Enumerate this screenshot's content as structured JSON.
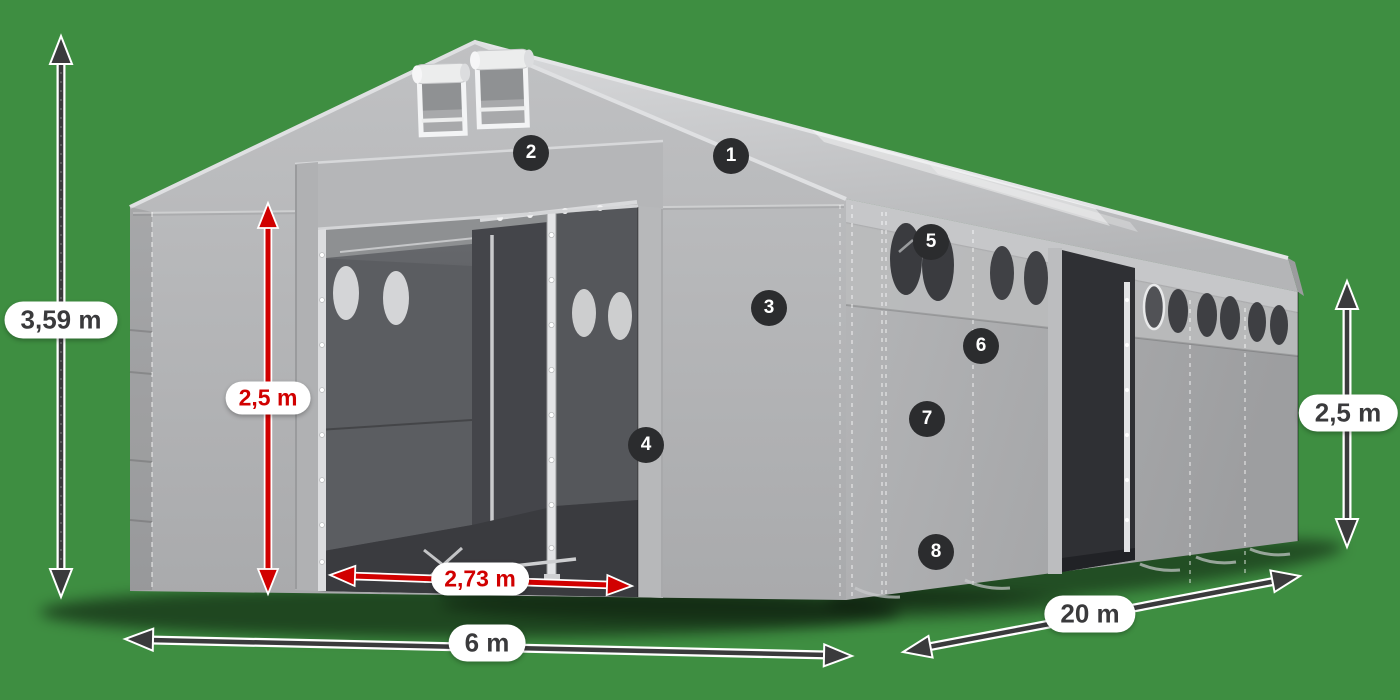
{
  "colors": {
    "background": "#3e8e41",
    "accent_red": "#d10000",
    "arrow_dark": "#3a3a3c",
    "badge_background": "#2b2c2e",
    "badge_text": "#ffffff",
    "label_background": "#ffffff",
    "label_text_dark": "#3a3a3c",
    "tent_fabric_light": "#c9cacc",
    "tent_fabric_mid": "#b3b4b6",
    "tent_interior_dark": "#4a4c50"
  },
  "diagram": {
    "dimension_labels": [
      {
        "id": "total-height",
        "label": "3,59 m",
        "style": "dark"
      },
      {
        "id": "door-height",
        "label": "2,5 m",
        "style": "red"
      },
      {
        "id": "door-width",
        "label": "2,73 m",
        "style": "red"
      },
      {
        "id": "front-width",
        "label": "6 m",
        "style": "dark"
      },
      {
        "id": "side-length",
        "label": "20 m",
        "style": "dark"
      },
      {
        "id": "side-height",
        "label": "2,5 m",
        "style": "dark"
      }
    ],
    "hotspots": [
      {
        "number": "1"
      },
      {
        "number": "2"
      },
      {
        "number": "3"
      },
      {
        "number": "4"
      },
      {
        "number": "5"
      },
      {
        "number": "6"
      },
      {
        "number": "7"
      },
      {
        "number": "8"
      }
    ]
  }
}
